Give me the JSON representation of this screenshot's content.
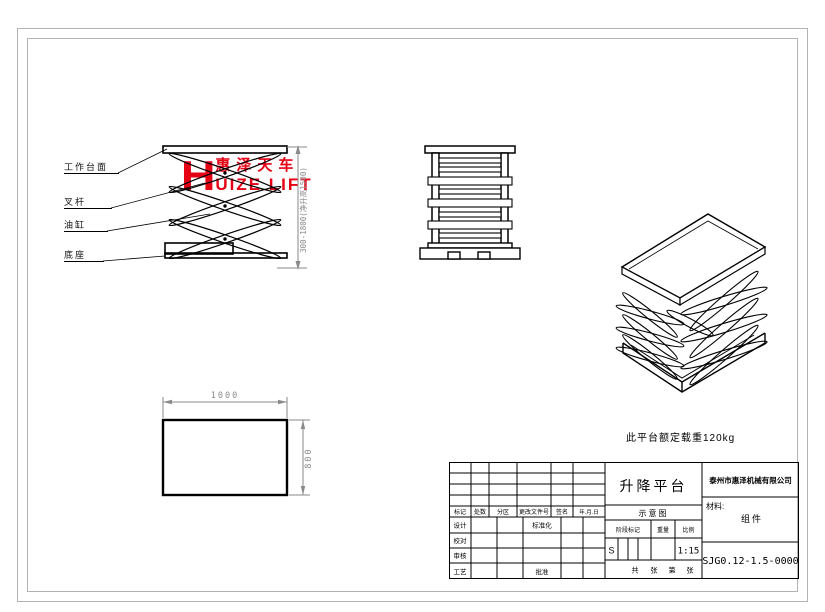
{
  "colors": {
    "line": "#000000",
    "frame_gray": "#b3b3b3",
    "dim_gray": "#8a8a8a",
    "logo_red": "#e60014"
  },
  "logo": {
    "big_letter": "H",
    "cn_text": "惠泽天车",
    "en_text": "UIZE LIFT"
  },
  "front_view": {
    "part_labels": [
      "工作台面",
      "叉杆",
      "油缸",
      "底座"
    ],
    "height_dim": "300-1800(净升高1500)"
  },
  "plan_view": {
    "width_dim": "1000",
    "height_dim": "800"
  },
  "note_text": "此平台额定载重120kg",
  "title_block": {
    "product_title": "升降平台",
    "drawing_type": "示意图",
    "company": "泰州市惠泽机械有限公司",
    "material_label": "材料:",
    "material_value": "组件",
    "drawing_number": "SJG0.12-1.5-0000",
    "rev_headers": [
      "标记",
      "处数",
      "分区",
      "更改文件号",
      "签名",
      "年.月.日"
    ],
    "role_labels": [
      "设计",
      "校对",
      "审核",
      "工艺"
    ],
    "extra_labels": [
      "标准化",
      "批准"
    ],
    "stage_headers": [
      "阶段标记",
      "重量",
      "比例"
    ],
    "stage_mark": "S",
    "scale": "1:15",
    "sheet_labels": [
      "共",
      "张",
      "第",
      "张"
    ]
  }
}
